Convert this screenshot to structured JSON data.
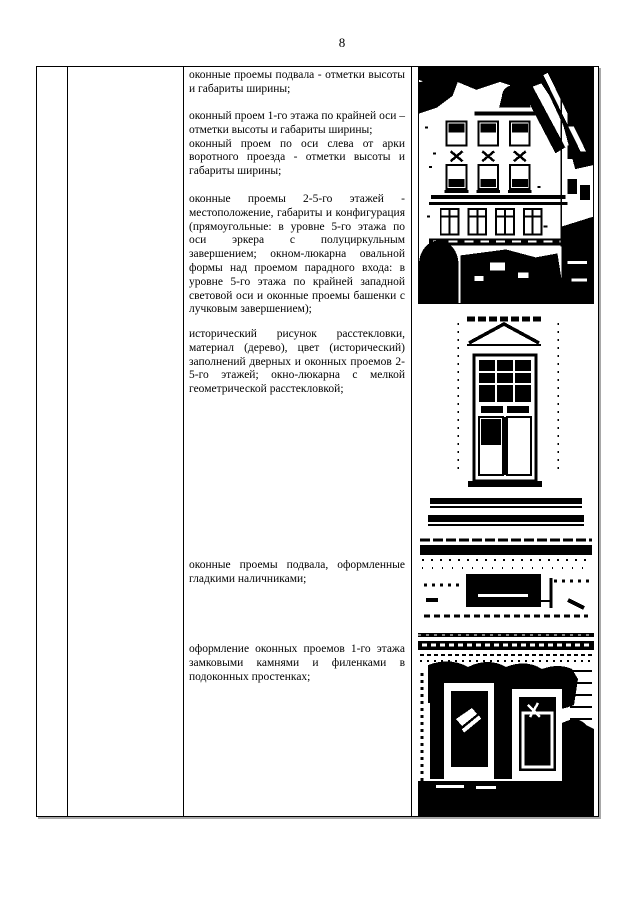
{
  "page_number": "8",
  "colors": {
    "ink": "#000000",
    "paper": "#ffffff",
    "scan_shadow": "#a8a8a8"
  },
  "table": {
    "text_column": {
      "paragraphs": [
        {
          "text": "оконные проемы подвала - отметки высоты и габариты ширины;"
        },
        {
          "text": "оконный проем 1-го этажа по крайней оси – отметки высоты и габариты ширины;"
        },
        {
          "text": "оконный проем по оси слева от арки воротного проезда - отметки высоты и габариты ширины;"
        },
        {
          "text": "оконные проемы 2-5-го этажей - местоположение, габариты и конфигурация (прямоугольные: в уровне 5-го этажа по оси эркера с полуциркульным завершением; окном-люкарна овальной формы над проемом парадного входа: в уровне 5-го этажа по крайней западной световой оси и оконные проемы башенки с лучковым завершением);"
        },
        {
          "text": "исторический рисунок расстекловки, материал (дерево), цвет (исторический) заполнений дверных и оконных проемов 2-5-го этажей; окно-люкарна с мелкой геометрической расстекловкой;"
        },
        {
          "text": "оконные проемы подвала, оформленные гладкими наличниками;"
        },
        {
          "text": "оформление оконных проемов 1-го этажа замковыми камнями и филенками в подоконных простенках;"
        }
      ]
    },
    "photo_column": {
      "photos": [
        {
          "name": "building-facade-photo"
        },
        {
          "name": "window-detail-photo"
        },
        {
          "name": "basement-window-photo"
        },
        {
          "name": "first-floor-windows-photo"
        }
      ]
    }
  }
}
